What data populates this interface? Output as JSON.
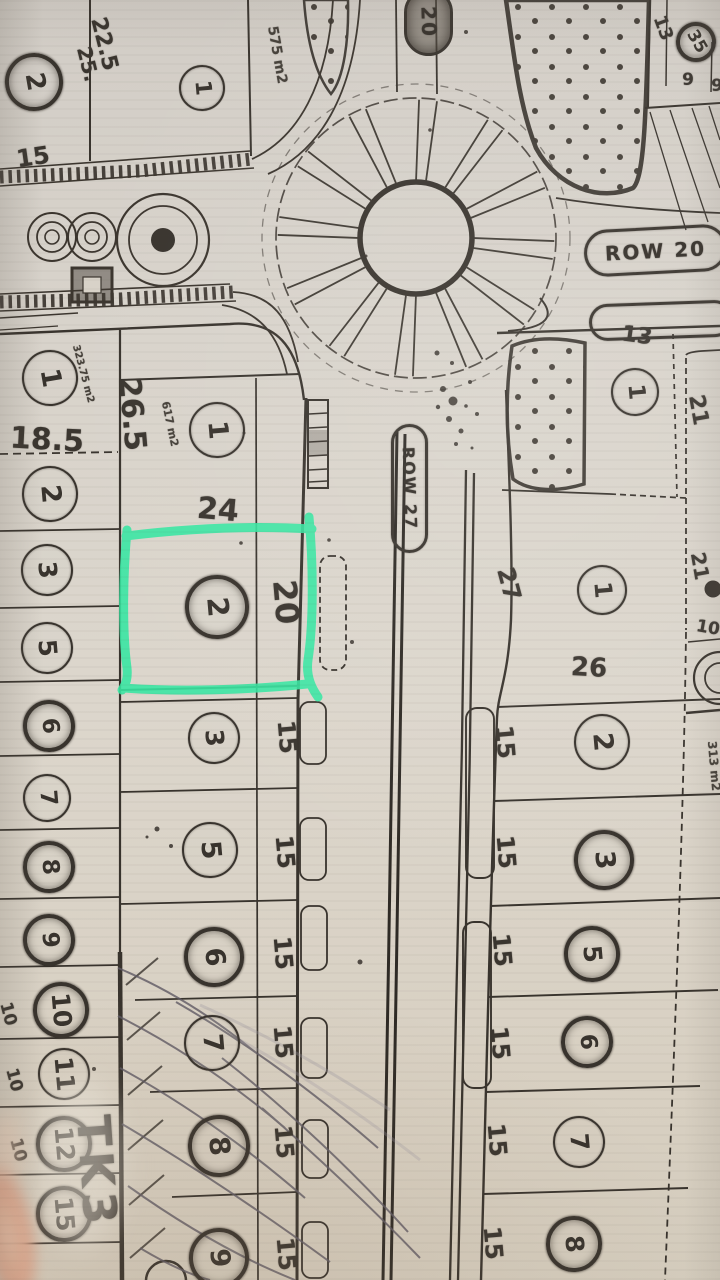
{
  "colors": {
    "paper": "#d8d2c8",
    "ink": "#38332d",
    "highlight_green": "#36e7a2",
    "pencil": "#5f5a64",
    "finger": "#e9b49c"
  },
  "map": {
    "road_stamps": [
      {
        "text": "ROW 20",
        "x": 584,
        "y": 227,
        "w": 137,
        "h": 41,
        "rot": -3,
        "size": 20,
        "vert": false,
        "dark": false
      },
      {
        "text": "ROW 27",
        "x": 391,
        "y": 424,
        "w": 31,
        "h": 123,
        "rot": 0,
        "size": 16,
        "vert": true,
        "dark": false
      },
      {
        "text": "20",
        "x": 404,
        "y": -12,
        "w": 43,
        "h": 62,
        "rot": 0,
        "size": 20,
        "vert": true,
        "dark": true
      },
      {
        "text": "",
        "x": 589,
        "y": 302,
        "w": 138,
        "h": 31,
        "rot": -2,
        "size": 18,
        "vert": false,
        "dark": false
      }
    ],
    "plot_circles": [
      {
        "n": "2",
        "x": 30,
        "y": 78,
        "rad": 25,
        "rot": 80,
        "d": true
      },
      {
        "n": "1",
        "x": 200,
        "y": 86,
        "rad": 21,
        "rot": 85,
        "d": false
      },
      {
        "n": "35",
        "x": 692,
        "y": 38,
        "rad": 16,
        "rot": 60,
        "d": true
      },
      {
        "n": "1",
        "x": 48,
        "y": 376,
        "rad": 26,
        "rot": 80,
        "d": false
      },
      {
        "n": "2",
        "x": 48,
        "y": 492,
        "rad": 26,
        "rot": 85,
        "d": false
      },
      {
        "n": "3",
        "x": 45,
        "y": 568,
        "rad": 24,
        "rot": 85,
        "d": false
      },
      {
        "n": "5",
        "x": 45,
        "y": 646,
        "rad": 24,
        "rot": 85,
        "d": false
      },
      {
        "n": "6",
        "x": 45,
        "y": 722,
        "rad": 22,
        "rot": 85,
        "d": true
      },
      {
        "n": "7",
        "x": 45,
        "y": 796,
        "rad": 22,
        "rot": 85,
        "d": false
      },
      {
        "n": "8",
        "x": 45,
        "y": 863,
        "rad": 22,
        "rot": 85,
        "d": true
      },
      {
        "n": "9",
        "x": 45,
        "y": 936,
        "rad": 22,
        "rot": 85,
        "d": true
      },
      {
        "n": "10",
        "x": 57,
        "y": 1006,
        "rad": 24,
        "rot": 85,
        "d": true
      },
      {
        "n": "11",
        "x": 62,
        "y": 1072,
        "rad": 24,
        "rot": 85,
        "d": false
      },
      {
        "n": "12",
        "x": 60,
        "y": 1140,
        "rad": 24,
        "rot": 85,
        "d": true
      },
      {
        "n": "15",
        "x": 60,
        "y": 1210,
        "rad": 24,
        "rot": 85,
        "d": true
      },
      {
        "n": "1",
        "x": 215,
        "y": 428,
        "rad": 26,
        "rot": 85,
        "d": false
      },
      {
        "n": "2",
        "x": 213,
        "y": 603,
        "rad": 28,
        "rot": 85,
        "d": true
      },
      {
        "n": "3",
        "x": 212,
        "y": 736,
        "rad": 24,
        "rot": 85,
        "d": false
      },
      {
        "n": "5",
        "x": 208,
        "y": 848,
        "rad": 26,
        "rot": 85,
        "d": false
      },
      {
        "n": "6",
        "x": 210,
        "y": 953,
        "rad": 26,
        "rot": 85,
        "d": true
      },
      {
        "n": "7",
        "x": 210,
        "y": 1041,
        "rad": 26,
        "rot": 85,
        "d": false
      },
      {
        "n": "8",
        "x": 215,
        "y": 1142,
        "rad": 27,
        "rot": 85,
        "d": true
      },
      {
        "n": "9",
        "x": 215,
        "y": 1254,
        "rad": 26,
        "rot": 85,
        "d": true
      },
      {
        "n": "1",
        "x": 633,
        "y": 390,
        "rad": 22,
        "rot": 85,
        "d": false
      },
      {
        "n": "1",
        "x": 600,
        "y": 588,
        "rad": 23,
        "rot": 85,
        "d": false
      },
      {
        "n": "2",
        "x": 600,
        "y": 740,
        "rad": 26,
        "rot": 85,
        "d": false
      },
      {
        "n": "3",
        "x": 600,
        "y": 856,
        "rad": 26,
        "rot": 85,
        "d": true
      },
      {
        "n": "5",
        "x": 588,
        "y": 950,
        "rad": 24,
        "rot": 85,
        "d": true
      },
      {
        "n": "6",
        "x": 583,
        "y": 1038,
        "rad": 22,
        "rot": 85,
        "d": true
      },
      {
        "n": "7",
        "x": 577,
        "y": 1140,
        "rad": 24,
        "rot": 85,
        "d": false
      },
      {
        "n": "8",
        "x": 570,
        "y": 1240,
        "rad": 24,
        "rot": 85,
        "d": true
      }
    ],
    "dim_labels": [
      {
        "t": "22.5",
        "x": 104,
        "y": 44,
        "rot": 76,
        "s": 22
      },
      {
        "t": "25.",
        "x": 88,
        "y": 64,
        "rot": 76,
        "s": 20
      },
      {
        "t": "15",
        "x": 33,
        "y": 157,
        "rot": -8,
        "s": 24
      },
      {
        "t": "13",
        "x": 663,
        "y": 28,
        "rot": 70,
        "s": 18
      },
      {
        "t": "9",
        "x": 688,
        "y": 80,
        "rot": 0,
        "s": 17
      },
      {
        "t": "9",
        "x": 717,
        "y": 86,
        "rot": 0,
        "s": 17
      },
      {
        "t": "13",
        "x": 637,
        "y": 336,
        "rot": 8,
        "s": 22
      },
      {
        "t": "21",
        "x": 698,
        "y": 410,
        "rot": 80,
        "s": 22
      },
      {
        "t": "26.5",
        "x": 132,
        "y": 414,
        "rot": 85,
        "s": 30
      },
      {
        "t": "18.5",
        "x": 47,
        "y": 440,
        "rot": 3,
        "s": 30
      },
      {
        "t": "24",
        "x": 218,
        "y": 510,
        "rot": 5,
        "s": 30
      },
      {
        "t": "20",
        "x": 286,
        "y": 602,
        "rot": 85,
        "s": 32
      },
      {
        "t": "27",
        "x": 509,
        "y": 584,
        "rot": 75,
        "s": 24
      },
      {
        "t": "26",
        "x": 589,
        "y": 668,
        "rot": 3,
        "s": 26
      },
      {
        "t": "21",
        "x": 700,
        "y": 566,
        "rot": 80,
        "s": 20
      },
      {
        "t": "10",
        "x": 708,
        "y": 628,
        "rot": 10,
        "s": 17
      },
      {
        "t": "15",
        "x": 287,
        "y": 737,
        "rot": 85,
        "s": 24
      },
      {
        "t": "15",
        "x": 285,
        "y": 852,
        "rot": 85,
        "s": 24
      },
      {
        "t": "15",
        "x": 283,
        "y": 953,
        "rot": 85,
        "s": 24
      },
      {
        "t": "15",
        "x": 283,
        "y": 1042,
        "rot": 85,
        "s": 24
      },
      {
        "t": "15",
        "x": 284,
        "y": 1142,
        "rot": 85,
        "s": 24
      },
      {
        "t": "15",
        "x": 286,
        "y": 1254,
        "rot": 85,
        "s": 24
      },
      {
        "t": "15",
        "x": 505,
        "y": 742,
        "rot": 85,
        "s": 24
      },
      {
        "t": "15",
        "x": 506,
        "y": 852,
        "rot": 85,
        "s": 24
      },
      {
        "t": "15",
        "x": 502,
        "y": 950,
        "rot": 85,
        "s": 24
      },
      {
        "t": "15",
        "x": 500,
        "y": 1043,
        "rot": 85,
        "s": 24
      },
      {
        "t": "15",
        "x": 497,
        "y": 1140,
        "rot": 85,
        "s": 24
      },
      {
        "t": "15",
        "x": 493,
        "y": 1243,
        "rot": 85,
        "s": 24
      },
      {
        "t": "10",
        "x": 8,
        "y": 1014,
        "rot": 75,
        "s": 17
      },
      {
        "t": "10",
        "x": 14,
        "y": 1080,
        "rot": 75,
        "s": 17
      },
      {
        "t": "10",
        "x": 18,
        "y": 1150,
        "rot": 75,
        "s": 17
      }
    ],
    "area_labels": [
      {
        "t": "575 m2",
        "x": 277,
        "y": 55,
        "rot": 80,
        "s": 14
      },
      {
        "t": "323.75 m2",
        "x": 83,
        "y": 374,
        "rot": 75,
        "s": 10
      },
      {
        "t": "617 m2",
        "x": 170,
        "y": 424,
        "rot": 78,
        "s": 11
      },
      {
        "t": "313 m2",
        "x": 714,
        "y": 766,
        "rot": 85,
        "s": 12
      }
    ],
    "zone_label": {
      "text": "TK3",
      "x": 97,
      "y": 1172,
      "rot": 86,
      "size": 46
    }
  }
}
